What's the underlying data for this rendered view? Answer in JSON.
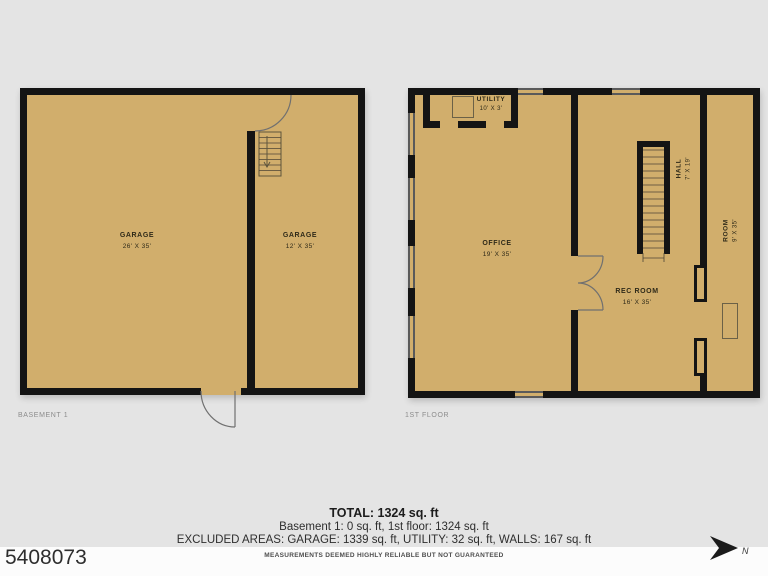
{
  "colors": {
    "background": "#e4e4e4",
    "floor_fill": "#d1ae6c",
    "wall": "#141414",
    "window_line": "#5a5a5a",
    "footer_background": "#fcfcfc"
  },
  "basement": {
    "plan_label": "BASEMENT 1",
    "garage_main": {
      "name": "GARAGE",
      "dims": "26' X 35'"
    },
    "garage_side": {
      "name": "GARAGE",
      "dims": "12' X 35'"
    }
  },
  "first_floor": {
    "plan_label": "1ST FLOOR",
    "utility": {
      "name": "UTILITY",
      "dims": "10' X 3'"
    },
    "office": {
      "name": "OFFICE",
      "dims": "19' X 35'"
    },
    "rec_room": {
      "name": "REC ROOM",
      "dims": "16' X 35'"
    },
    "hall": {
      "name": "HALL",
      "dims": "7' X 19'"
    },
    "room": {
      "name": "ROOM",
      "dims": "9' X 35'"
    }
  },
  "summary": {
    "total": "TOTAL: 1324 sq. ft",
    "floors": "Basement 1: 0 sq. ft, 1st floor: 1324 sq. ft",
    "excluded": "EXCLUDED AREAS: GARAGE: 1339 sq. ft, UTILITY: 32 sq. ft, WALLS: 167 sq. ft",
    "disclaimer": "MEASUREMENTS DEEMED HIGHLY RELIABLE BUT NOT GUARANTEED"
  },
  "photo_id": "5408073",
  "compass_label": "N"
}
